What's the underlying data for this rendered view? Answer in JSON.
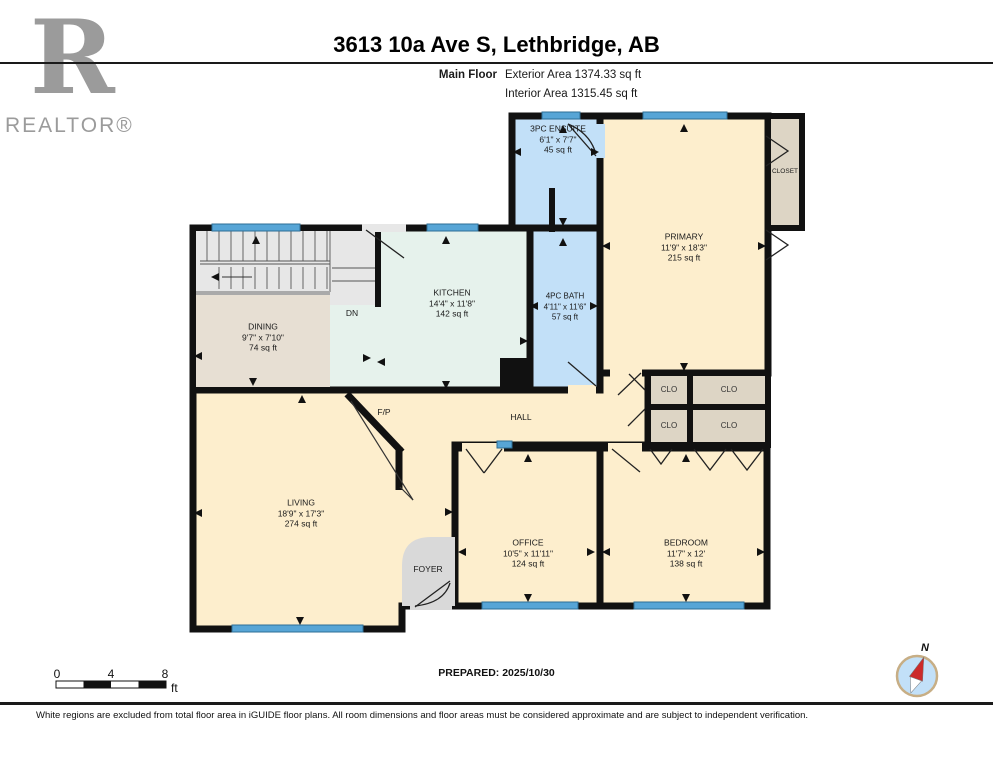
{
  "header": {
    "brand_mark": "R",
    "brand": "REALTOR®",
    "title": "3613 10a Ave S, Lethbridge, AB",
    "floor_label": "Main Floor",
    "exterior_area": "Exterior Area 1374.33 sq ft",
    "interior_area": "Interior Area 1315.45 sq ft"
  },
  "rooms": [
    {
      "name": "3PC ENSUITE",
      "dims": "6'1\" x 7'7\"",
      "area": "45 sq ft"
    },
    {
      "name": "PRIMARY",
      "dims": "11'9\" x 18'3\"",
      "area": "215 sq ft"
    },
    {
      "name": "KITCHEN",
      "dims": "14'4\" x 11'8\"",
      "area": "142 sq ft"
    },
    {
      "name": "4PC BATH",
      "dims": "4'11\" x 11'6\"",
      "area": "57 sq ft"
    },
    {
      "name": "DINING",
      "dims": "9'7\" x 7'10\"",
      "area": "74 sq ft"
    },
    {
      "name": "LIVING",
      "dims": "18'9\" x 17'3\"",
      "area": "274 sq ft"
    },
    {
      "name": "OFFICE",
      "dims": "10'5\" x 11'11\"",
      "area": "124 sq ft"
    },
    {
      "name": "BEDROOM",
      "dims": "11'7\" x 12'",
      "area": "138 sq ft"
    }
  ],
  "labels": {
    "hall": "HALL",
    "foyer": "FOYER",
    "fireplace": "F/P",
    "stairs_down": "DN",
    "closet": "CLOSET",
    "clo": "CLO"
  },
  "scale_bar": {
    "t0": "0",
    "t4": "4",
    "t8": "8",
    "unit": "ft"
  },
  "compass": {
    "north": "N"
  },
  "footer": {
    "prepared": "PREPARED: 2025/10/30",
    "disclaimer": "White regions are excluded from total floor area in iGUIDE floor plans. All room dimensions and floor areas must be considered approximate and are subject to independent verification."
  },
  "colors": {
    "wall": "#111111",
    "room_cream": "#fdeecd",
    "room_blue": "#c2e0f8",
    "room_mint": "#e6f2ec",
    "dining_tan": "#e7dfd3",
    "closet_tan": "#ddd5c5",
    "stair_gray": "#e7e7e7",
    "foyer_gray": "#d9d9d9",
    "window_blue": "#57a5d6",
    "compass_red": "#cc2a2a",
    "logo_gray": "#9b9b9b"
  }
}
